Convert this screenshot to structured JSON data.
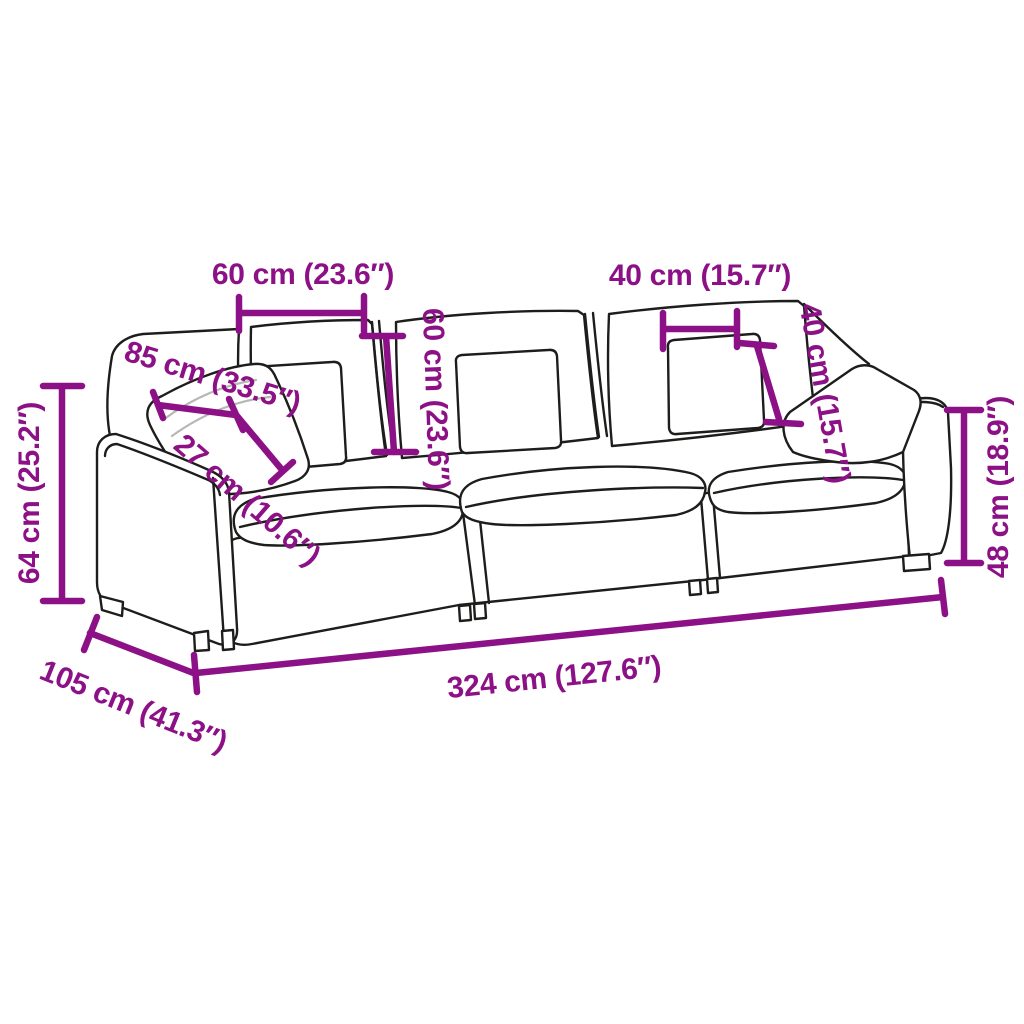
{
  "title": "Sofa dimensions diagram",
  "product": "3-seat modular sofa with cushions",
  "style": {
    "background": "#ffffff",
    "line_color": "#1d1d1b",
    "dimension_color": "#8d1186"
  },
  "dimensions": {
    "back_cushion_width": {
      "label": "60 cm (23.6″)",
      "cm": 60,
      "inches": 23.6
    },
    "headrest_cushion_width": {
      "label": "40 cm (15.7″)",
      "cm": 40,
      "inches": 15.7
    },
    "backrest_cushion_height": {
      "label": "60 cm (23.6″)",
      "cm": 60,
      "inches": 23.6
    },
    "throw_pillow_height": {
      "label": "40 cm (15.7″)",
      "cm": 40,
      "inches": 15.7
    },
    "total_height": {
      "label": "64 cm (25.2″)",
      "cm": 64,
      "inches": 25.2
    },
    "armrest_height": {
      "label": "48 cm (18.9″)",
      "cm": 48,
      "inches": 18.9
    },
    "back_pillow_width": {
      "label": "85 cm (33.5″)",
      "cm": 85,
      "inches": 33.5
    },
    "pillow_thickness": {
      "label": "27 cm (10.6″)",
      "cm": 27,
      "inches": 10.6
    },
    "sofa_depth": {
      "label": "105 cm (41.3″)",
      "cm": 105,
      "inches": 41.3
    },
    "sofa_width": {
      "label": "324 cm (127.6″)",
      "cm": 324,
      "inches": 127.6
    }
  }
}
